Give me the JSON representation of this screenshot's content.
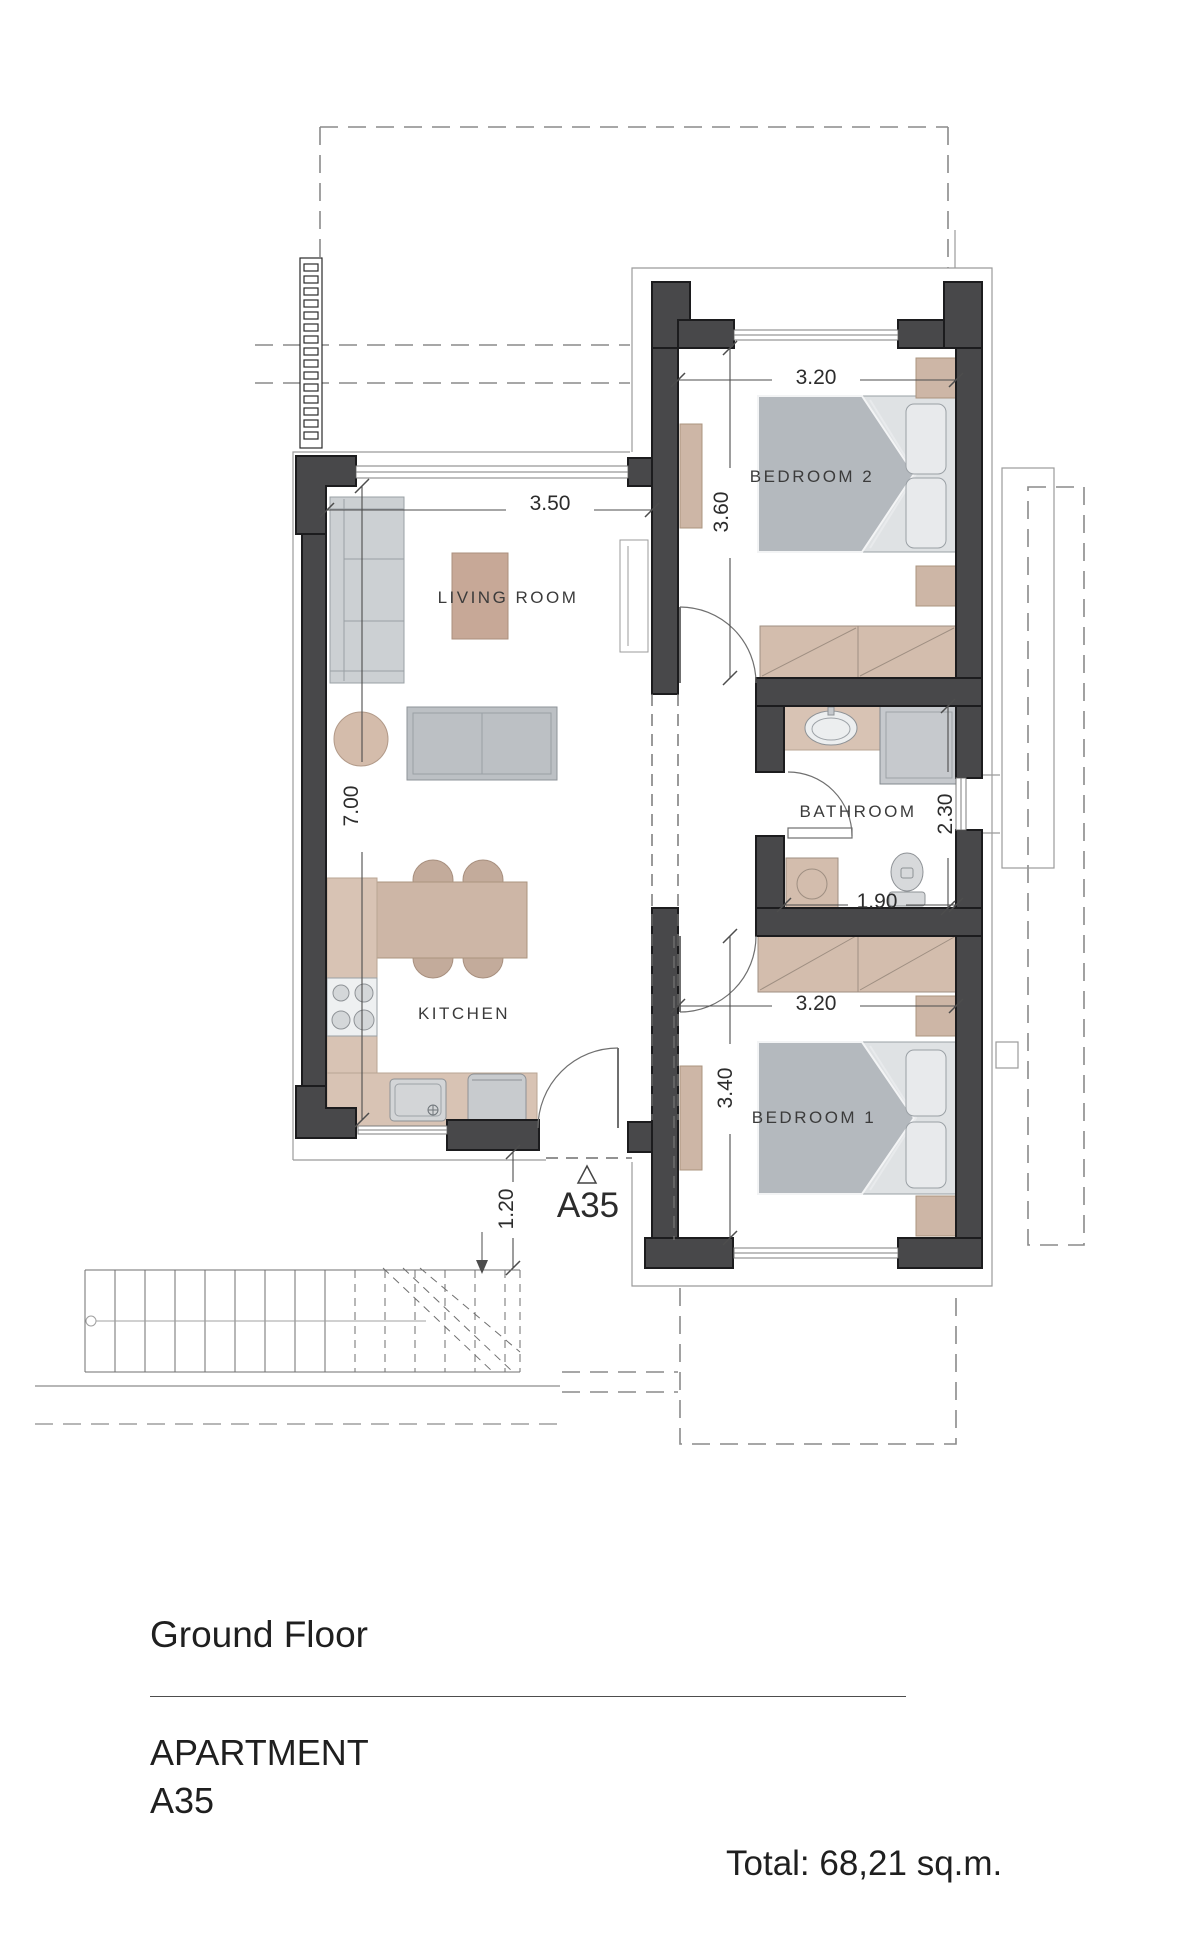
{
  "plan": {
    "rooms": {
      "living": "LIVING ROOM",
      "kitchen": "KITCHEN",
      "bedroom2": "BEDROOM 2",
      "bathroom": "BATHROOM",
      "bedroom1": "BEDROOM 1"
    },
    "dims": {
      "living_w": "3.50",
      "living_h": "7.00",
      "bedroom2_w": "3.20",
      "bedroom2_h": "3.60",
      "bathroom_w": "1.90",
      "bathroom_h": "2.30",
      "bedroom1_w": "3.20",
      "bedroom1_h": "3.40",
      "entrance": "1.20"
    },
    "marker": "A35"
  },
  "footer": {
    "floor": "Ground Floor",
    "type": "APARTMENT",
    "unit": "A35",
    "total": "Total: 68,21 sq.m."
  },
  "colors": {
    "wall": "#48484a",
    "furniture_tan": "#cdb6a6",
    "furniture_gray": "#c9ccd0",
    "line_gray": "#8a8a8a"
  }
}
